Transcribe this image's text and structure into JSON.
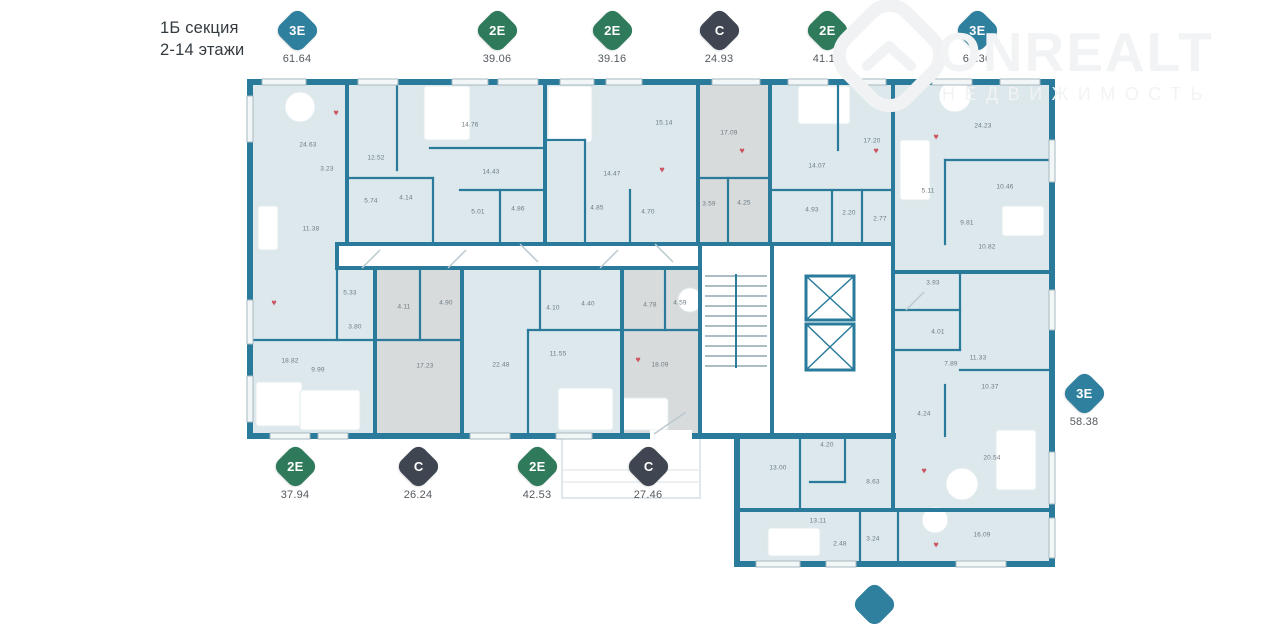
{
  "header": {
    "line1": "1Б секция",
    "line2": "2-14 этажи"
  },
  "watermark": {
    "brand": "ONREALT",
    "subtitle": "НЕДВИЖИМОСТЬ"
  },
  "colors": {
    "badge_teal": "#2f7f9f",
    "badge_green": "#2e7a5b",
    "badge_dark": "#3f4651",
    "wall": "#2a7b9b",
    "room_fill": "#dce8ec",
    "room_fill_gray": "#d7dbdc",
    "heart": "#cd5560"
  },
  "badges": [
    {
      "type": "3Е",
      "area": "61.64",
      "variant": "teal"
    },
    {
      "type": "2Е",
      "area": "39.06",
      "variant": "green"
    },
    {
      "type": "2Е",
      "area": "39.16",
      "variant": "green"
    },
    {
      "type": "С",
      "area": "24.93",
      "variant": "dark"
    },
    {
      "type": "2Е",
      "area": "41.17",
      "variant": "green"
    },
    {
      "type": "3Е",
      "area": "64.36",
      "variant": "teal"
    },
    {
      "type": "2Е",
      "area": "37.94",
      "variant": "green"
    },
    {
      "type": "С",
      "area": "26.24",
      "variant": "dark"
    },
    {
      "type": "2Е",
      "area": "42.53",
      "variant": "green"
    },
    {
      "type": "С",
      "area": "27.46",
      "variant": "dark"
    },
    {
      "type": "3Е",
      "area": "58.38",
      "variant": "teal"
    }
  ],
  "plan": {
    "rooms": [
      {
        "a": "24.63",
        "x": 308,
        "y": 145
      },
      {
        "a": "3.23",
        "x": 327,
        "y": 169
      },
      {
        "a": "12.52",
        "x": 376,
        "y": 158
      },
      {
        "a": "5.74",
        "x": 371,
        "y": 201
      },
      {
        "a": "4.14",
        "x": 406,
        "y": 198
      },
      {
        "a": "11.38",
        "x": 311,
        "y": 229
      },
      {
        "a": "14.76",
        "x": 470,
        "y": 125
      },
      {
        "a": "14.43",
        "x": 491,
        "y": 172
      },
      {
        "a": "5.01",
        "x": 478,
        "y": 212
      },
      {
        "a": "4.86",
        "x": 518,
        "y": 209
      },
      {
        "a": "4.85",
        "x": 597,
        "y": 208
      },
      {
        "a": "14.47",
        "x": 612,
        "y": 174
      },
      {
        "a": "15.14",
        "x": 664,
        "y": 123
      },
      {
        "a": "4.70",
        "x": 648,
        "y": 212
      },
      {
        "a": "17.09",
        "x": 729,
        "y": 133
      },
      {
        "a": "3.59",
        "x": 709,
        "y": 204
      },
      {
        "a": "4.25",
        "x": 744,
        "y": 203
      },
      {
        "a": "14.07",
        "x": 817,
        "y": 166
      },
      {
        "a": "17.20",
        "x": 872,
        "y": 141
      },
      {
        "a": "4.93",
        "x": 812,
        "y": 210
      },
      {
        "a": "2.20",
        "x": 849,
        "y": 213
      },
      {
        "a": "2.77",
        "x": 880,
        "y": 219
      },
      {
        "a": "5.11",
        "x": 928,
        "y": 191
      },
      {
        "a": "24.23",
        "x": 983,
        "y": 126
      },
      {
        "a": "10.46",
        "x": 1005,
        "y": 187
      },
      {
        "a": "9.81",
        "x": 967,
        "y": 223
      },
      {
        "a": "10.82",
        "x": 987,
        "y": 247
      },
      {
        "a": "5.33",
        "x": 350,
        "y": 293
      },
      {
        "a": "3.80",
        "x": 355,
        "y": 327
      },
      {
        "a": "4.11",
        "x": 404,
        "y": 307
      },
      {
        "a": "4.90",
        "x": 446,
        "y": 303
      },
      {
        "a": "18.82",
        "x": 290,
        "y": 361
      },
      {
        "a": "9.99",
        "x": 318,
        "y": 370
      },
      {
        "a": "17.23",
        "x": 425,
        "y": 366
      },
      {
        "a": "22.48",
        "x": 501,
        "y": 365
      },
      {
        "a": "4.10",
        "x": 553,
        "y": 308
      },
      {
        "a": "4.40",
        "x": 588,
        "y": 304
      },
      {
        "a": "4.78",
        "x": 650,
        "y": 305
      },
      {
        "a": "4.59",
        "x": 680,
        "y": 303
      },
      {
        "a": "11.55",
        "x": 558,
        "y": 354
      },
      {
        "a": "18.09",
        "x": 660,
        "y": 365
      },
      {
        "a": "3.93",
        "x": 933,
        "y": 283
      },
      {
        "a": "4.01",
        "x": 938,
        "y": 332
      },
      {
        "a": "11.33",
        "x": 978,
        "y": 358
      },
      {
        "a": "7.89",
        "x": 951,
        "y": 364
      },
      {
        "a": "10.37",
        "x": 990,
        "y": 387
      },
      {
        "a": "4.24",
        "x": 924,
        "y": 414
      },
      {
        "a": "13.00",
        "x": 778,
        "y": 468
      },
      {
        "a": "4.20",
        "x": 827,
        "y": 445
      },
      {
        "a": "8.63",
        "x": 873,
        "y": 482
      },
      {
        "a": "20.54",
        "x": 992,
        "y": 458
      },
      {
        "a": "13.11",
        "x": 818,
        "y": 521
      },
      {
        "a": "2.48",
        "x": 840,
        "y": 544
      },
      {
        "a": "3.24",
        "x": 873,
        "y": 539
      },
      {
        "a": "16.09",
        "x": 982,
        "y": 535
      }
    ],
    "hearts": [
      [
        336,
        113
      ],
      [
        662,
        170
      ],
      [
        742,
        151
      ],
      [
        876,
        151
      ],
      [
        936,
        137
      ],
      [
        274,
        303
      ],
      [
        638,
        360
      ],
      [
        924,
        471
      ],
      [
        936,
        545
      ]
    ]
  }
}
